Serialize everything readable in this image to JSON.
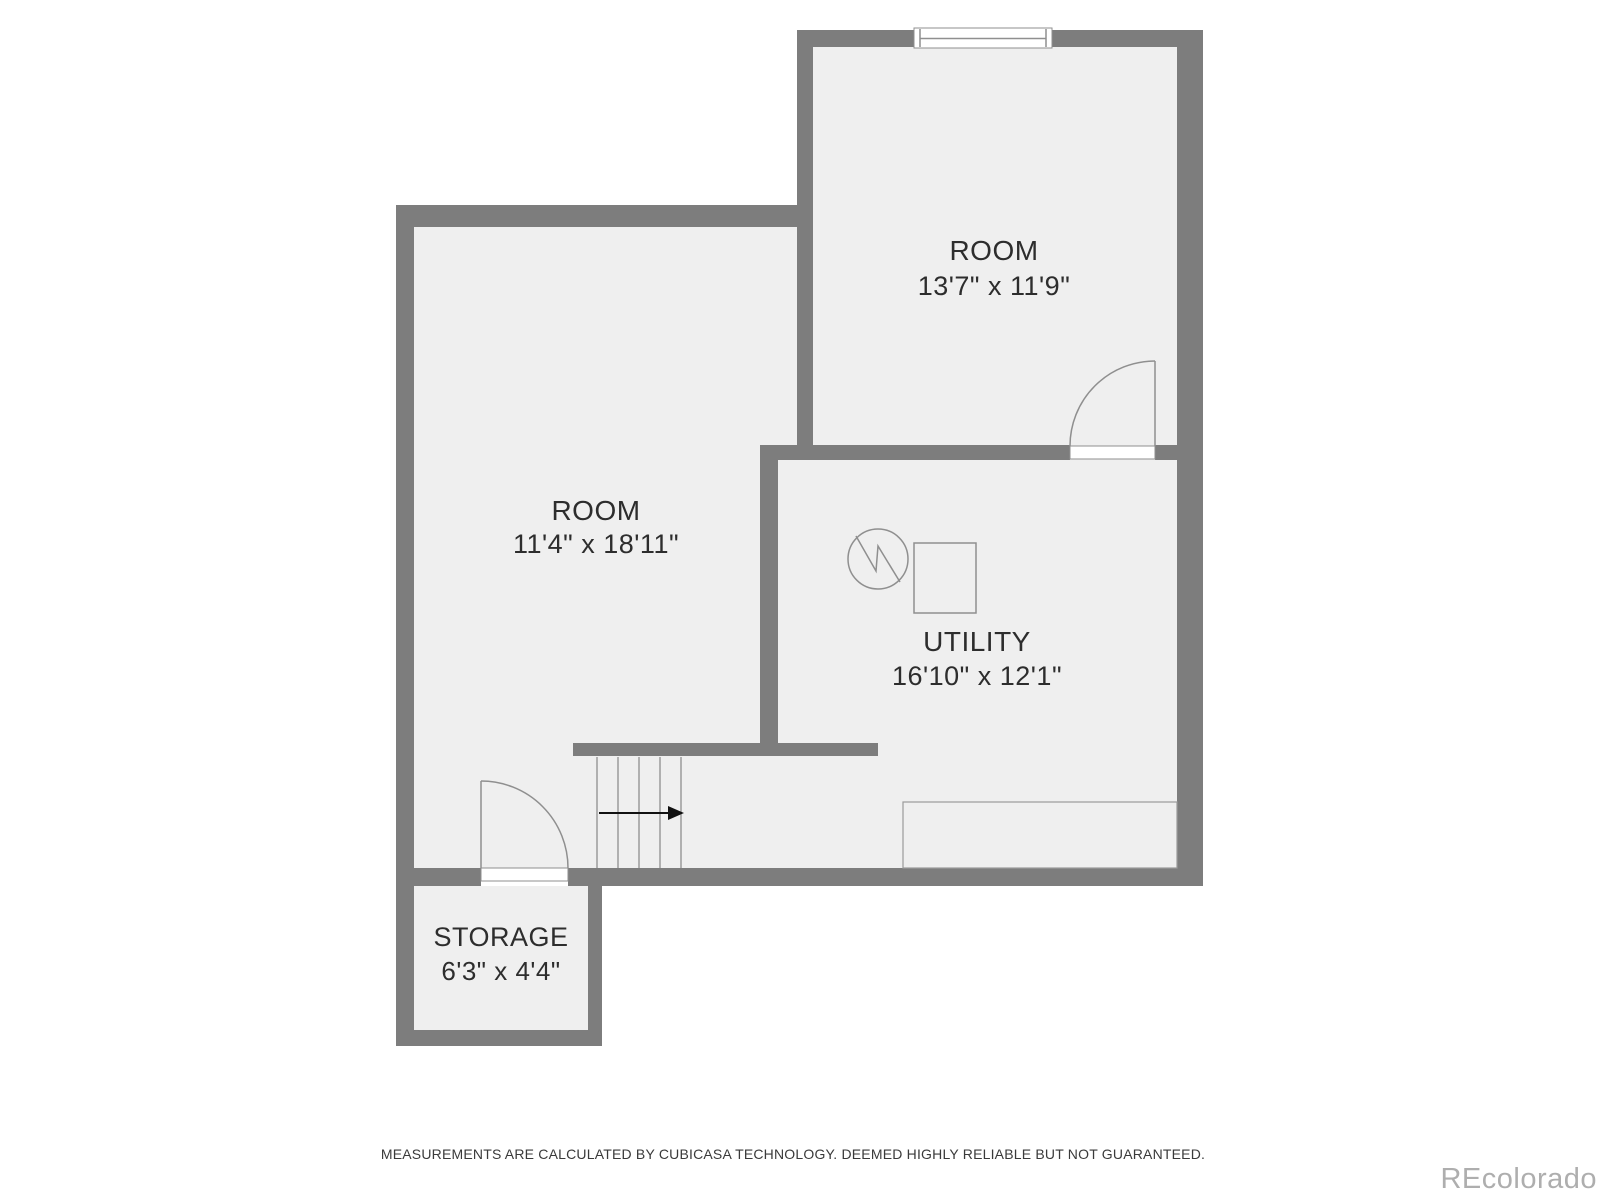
{
  "floor_plan": {
    "rooms": [
      {
        "name": "ROOM",
        "dimensions": "13'7\" x 11'9\""
      },
      {
        "name": "ROOM",
        "dimensions": "11'4\" x 18'11\""
      },
      {
        "name": "UTILITY",
        "dimensions": "16'10\" x 12'1\""
      },
      {
        "name": "STORAGE",
        "dimensions": "6'3\" x 4'4\""
      }
    ],
    "symbols": [
      "window",
      "door-swing-top",
      "door-swing-storage",
      "staircase",
      "stair-direction-arrow",
      "water-heater-circle-symbol",
      "furnace-square-symbol",
      "utility-bench"
    ],
    "disclaimer": "MEASUREMENTS ARE CALCULATED BY CUBICASA TECHNOLOGY. DEEMED HIGHLY RELIABLE BUT NOT GUARANTEED.",
    "watermark": "REcolorado",
    "colors": {
      "background": "#ffffff",
      "wall": "#7d7d7d",
      "floor": "#efefef",
      "symbol_line": "#8f8f8f",
      "text": "#2d2d2d",
      "watermark": "#aeaeae"
    }
  }
}
